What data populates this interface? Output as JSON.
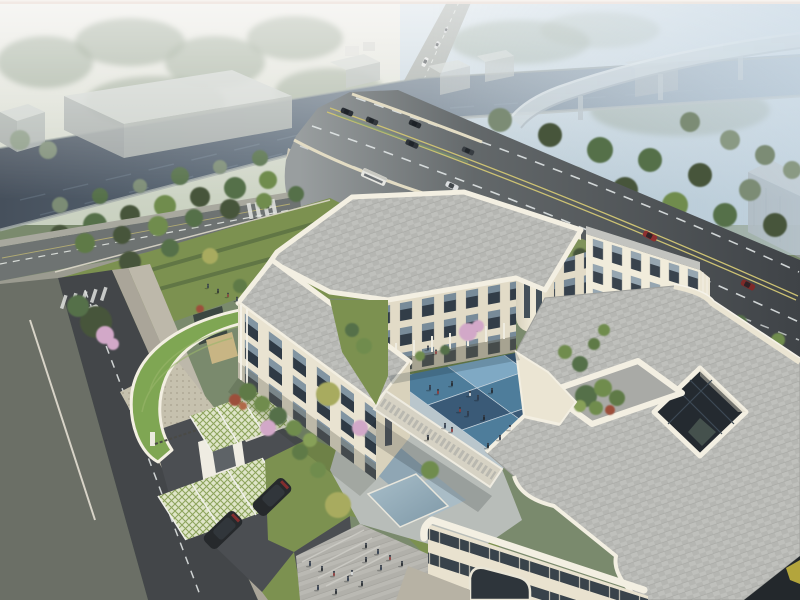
{
  "scene": {
    "type": "aerial-architectural-rendering",
    "description": "Bird's-eye architectural rendering: a cream three-storey courtyard building with grey paved roofs sits beside a canal crossed by a multi-lane road bridge; a curved expressway viaduct fades into blue morning haze at top right. The inner courtyard is paved in a blue checkerboard with small figures, a roof terrace holds a tree planter, and the grounds include a green-roofed gatehouse, cherry-blossom trees, grass-paver parking with dark SUVs and a paved plaza.",
    "environment": {
      "atmosphere": "hazy morning mist",
      "viewpoint": "high aerial three-quarter view"
    },
    "palette": {
      "cream": "#ebe5d3",
      "creamShade": "#d9d2bc",
      "trim": "#f3efe2",
      "roofGray": "#b5b6b2",
      "water": "#46505c",
      "waterFar": "#8aa0b2",
      "roadDark": "#3f4347",
      "roadLight": "#999e9f",
      "laneYellow": "#cdc273",
      "tileDark": "#3a5a77",
      "tileMid": "#4e7d9b",
      "tileLight": "#7fa9c4",
      "tilePale": "#9fc0d4",
      "lawn": "#7c9150",
      "gateGreen": "#7fa653",
      "blossom": "#d2a8c8",
      "suvDark": "#26292c",
      "carRed": "#8e2f2f",
      "busWhite": "#e6e6e1",
      "poolLight": "#a9bfca",
      "poolDark": "#7d97a6",
      "asphalt": "#4b4e52",
      "sand": "#c8b584",
      "mist": "#ffffff"
    },
    "site": {
      "building": {
        "storeys": 3,
        "wings": [
          "west-wing",
          "north-wing",
          "east-wing",
          "south-east-wing"
        ],
        "roof": "grey paver tiles with cream rounded parapets",
        "features": [
          "blue checkerboard courtyard",
          "elevated link corridor",
          "roof terrace tree planter",
          "square roof lightwell",
          "rounded corner tower",
          "arched ground entrance"
        ]
      },
      "landscape": [
        "green-roof gatehouse crescent",
        "cherry-blossom trees",
        "red maple shrubs",
        "hedge rows on north lawn",
        "grass-paver parking bays",
        "reflecting pool",
        "paved plaza with steps"
      ],
      "people_visible": {
        "courtyard": 15,
        "north_garden": 2,
        "north_lawn": 4,
        "south_court": 6,
        "plaza": 8
      },
      "vehicles": {
        "parked_suvs": 2,
        "local_street_van": 1,
        "local_street_car": 1,
        "avenue_cars": 2,
        "main_road": {
          "dark_cars": 5,
          "bus": 1,
          "white_car": 1,
          "red_cars": 2
        },
        "distant_road_vehicles": 3
      }
    },
    "infrastructure": {
      "canal": "dark slate water with concrete embankments",
      "bridge": "multi-lane road bridge with cream parapets over the canal",
      "viaduct": "curved elevated expressway fading into haze",
      "roads": [
        "main arterial with double yellow centreline and dashed lanes",
        "tree-lined avenue with crosswalk",
        "local street with dashed centreline and zebra crossing"
      ],
      "warehouse_boxes": 7
    }
  }
}
